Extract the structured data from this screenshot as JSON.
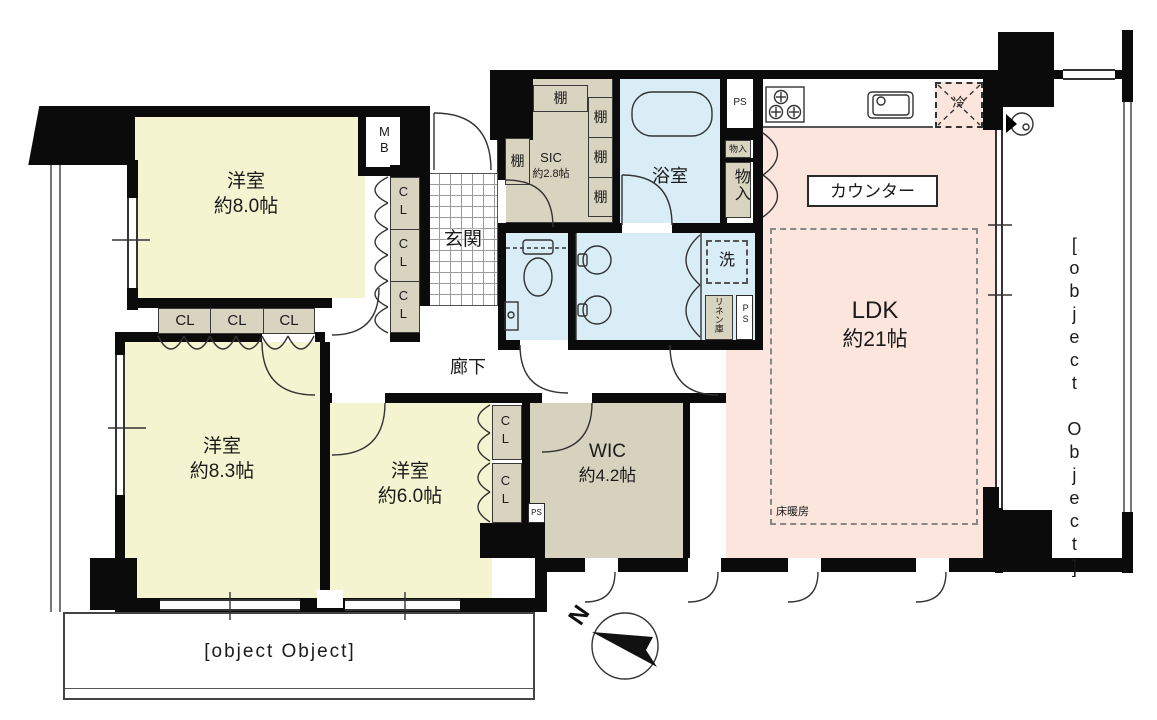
{
  "rooms": {
    "bedroom_8_0": {
      "name": "洋室",
      "area": "約8.0帖"
    },
    "bedroom_8_3": {
      "name": "洋室",
      "area": "約8.3帖"
    },
    "bedroom_6_0": {
      "name": "洋室",
      "area": "約6.0帖"
    },
    "ldk": {
      "name": "LDK",
      "area": "約21帖"
    },
    "wic": {
      "name": "WIC",
      "area": "約4.2帖"
    },
    "sic": {
      "name": "SIC",
      "area": "約2.8帖"
    },
    "bathroom": {
      "name": "浴室"
    },
    "entrance": {
      "name": "玄関"
    },
    "hallway": {
      "name": "廊下"
    },
    "balcony": {
      "name": "バルコニー"
    }
  },
  "labels": {
    "counter": "カウンター",
    "floor_heating": "床暖房",
    "washer": "洗",
    "linen": "リネン庫",
    "storage": "物入",
    "shelf": "棚",
    "closet": "CL",
    "meter_box": "MB",
    "pipe_space": "PS",
    "refrigerator": "冷",
    "north": "N"
  },
  "colors": {
    "bedroom_fill": "#f4f5d0",
    "ldk_fill": "#fbe5dc",
    "wet_area_fill": "#d8edf6",
    "storage_fill": "#d9d4c0",
    "wall": "#0b0b0b"
  }
}
